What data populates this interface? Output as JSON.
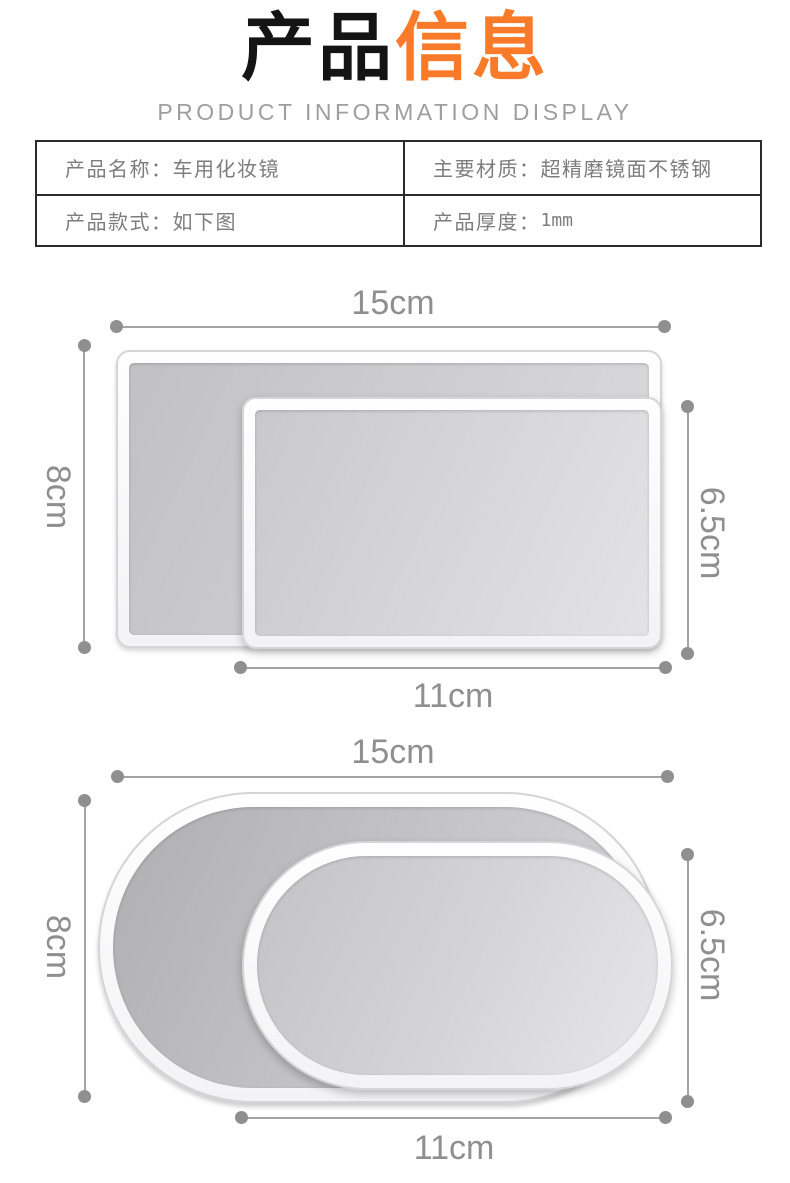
{
  "header": {
    "title_black": "产品",
    "title_accent": "信息",
    "subtitle": "PRODUCT INFORMATION DISPLAY",
    "accent_color": "#F97A28"
  },
  "spec_table": {
    "cells": [
      {
        "label": "产品名称：",
        "value": "车用化妆镜"
      },
      {
        "label": "主要材质：",
        "value": "超精磨镜面不锈钢"
      },
      {
        "label": "产品款式：",
        "value": "如下图"
      },
      {
        "label": "产品厚度：",
        "value": "1mm"
      }
    ]
  },
  "diagrams": [
    {
      "shape": "rectangle",
      "large_width": "15cm",
      "large_height": "8cm",
      "small_width": "11cm",
      "small_height": "6.5cm"
    },
    {
      "shape": "oval",
      "large_width": "15cm",
      "large_height": "8cm",
      "small_width": "11cm",
      "small_height": "6.5cm"
    }
  ],
  "colors": {
    "accent_orange": "#F97A28",
    "dimension_gray": "#8F8F8F",
    "table_text_gray": "#7D7D7D",
    "table_border_dark": "#2B2B2B"
  }
}
